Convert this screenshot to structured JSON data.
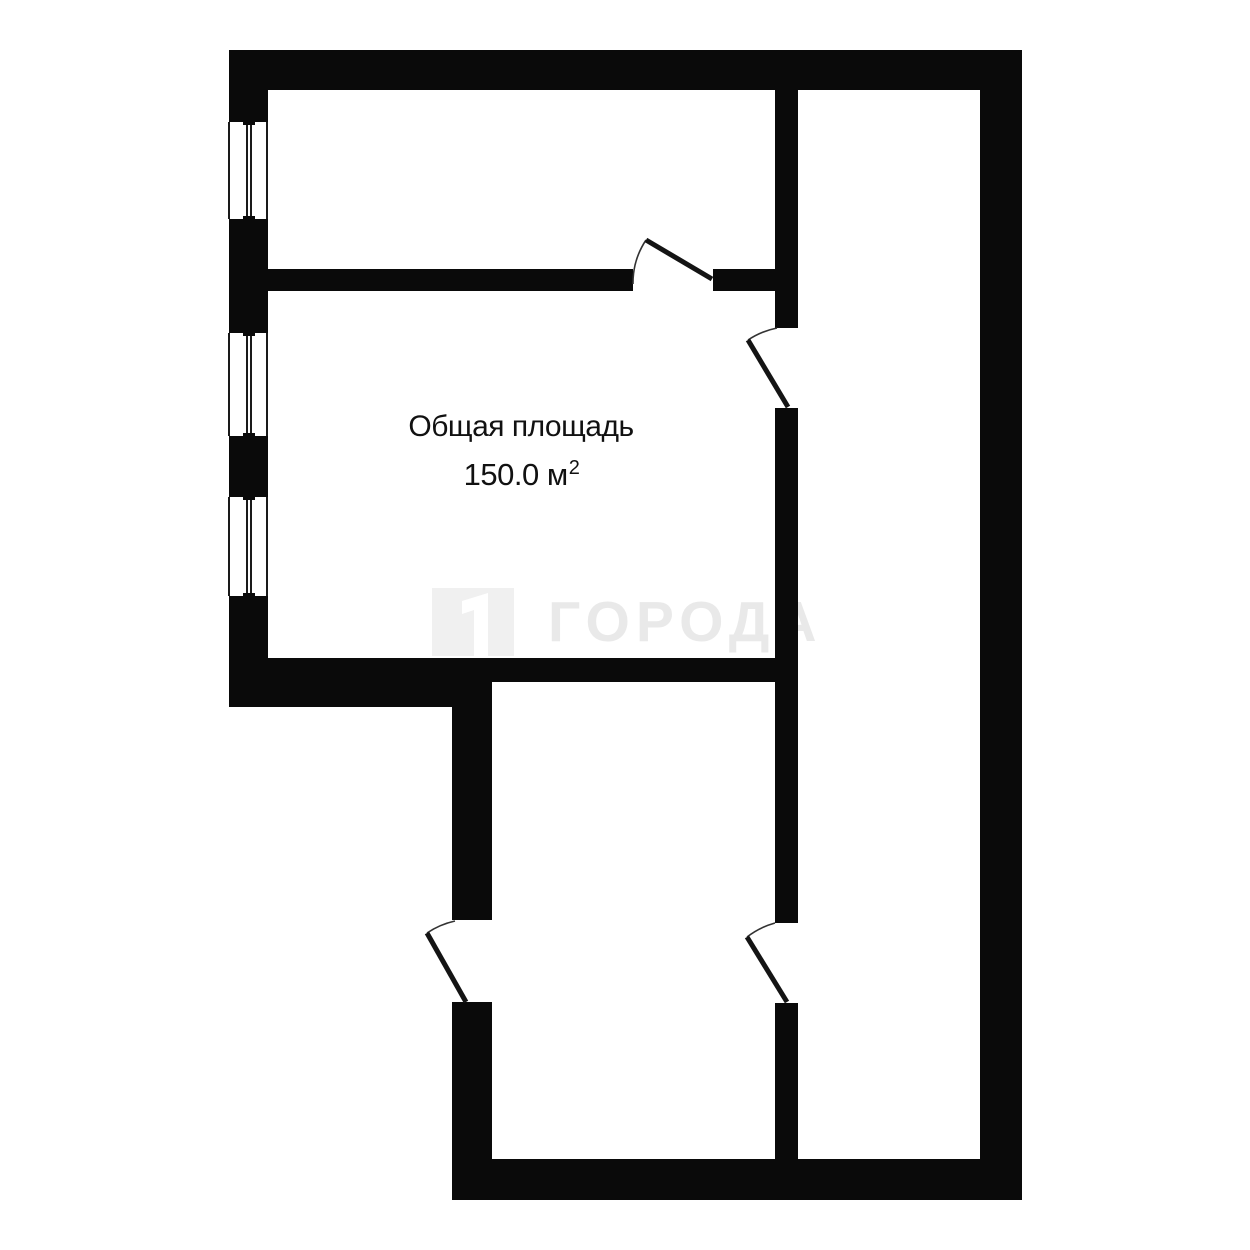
{
  "plan": {
    "area_label": "Общая площадь",
    "area_value_main": "150.0 м",
    "area_sup": "2",
    "rooms_visible": 4,
    "windows_count": 3,
    "door_swings_count": 4
  },
  "watermark": {
    "text": "ГОРОДА",
    "logo_icon": "building-flag-icon"
  },
  "colors": {
    "wall": "#0a0a0a",
    "background": "#ffffff",
    "label_text": "#111111",
    "door_arc": "#333333",
    "watermark_text": "#e9e9e9",
    "watermark_logo_bg": "#f0f0f0"
  }
}
